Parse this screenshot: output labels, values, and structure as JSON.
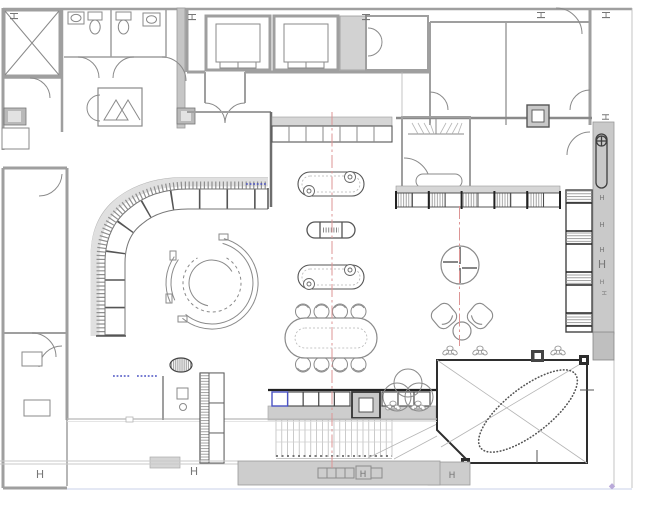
{
  "drawing": {
    "kind": "architectural-floor-plan",
    "width_px": 650,
    "height_px": 508
  },
  "colors": {
    "wall": "#9f9f9f",
    "dark": "#3f3f3f",
    "ln": "#8a8a8a",
    "thin": "#b5b5b5",
    "fillg": "#cdcdcd",
    "filll": "#e3e3e3",
    "red": "#dd9595",
    "blue": "#4a52c4",
    "lav": "#b9a9d9",
    "marker": "#777777"
  },
  "grid_markers": {
    "label": "H",
    "items": [
      {
        "x": 10,
        "y": 16,
        "r": 90,
        "s": 11
      },
      {
        "x": 188,
        "y": 17,
        "r": 90,
        "s": 11
      },
      {
        "x": 362,
        "y": 17,
        "r": 90,
        "s": 11
      },
      {
        "x": 537,
        "y": 15,
        "r": 90,
        "s": 11
      },
      {
        "x": 602,
        "y": 15,
        "r": 90,
        "s": 11
      },
      {
        "x": 602,
        "y": 117,
        "r": 90,
        "s": 10
      },
      {
        "x": 602,
        "y": 200,
        "r": 0,
        "s": 7
      },
      {
        "x": 602,
        "y": 227,
        "r": 0,
        "s": 7
      },
      {
        "x": 602,
        "y": 252,
        "r": 0,
        "s": 7
      },
      {
        "x": 602,
        "y": 268,
        "r": 0,
        "s": 11
      },
      {
        "x": 602,
        "y": 284,
        "r": 0,
        "s": 6
      },
      {
        "x": 602,
        "y": 293,
        "r": 90,
        "s": 6
      },
      {
        "x": 40,
        "y": 478,
        "r": 0,
        "s": 11
      },
      {
        "x": 194,
        "y": 475,
        "r": 0,
        "s": 11
      },
      {
        "x": 363,
        "y": 477,
        "r": 0,
        "s": 9
      },
      {
        "x": 452,
        "y": 478,
        "r": 0,
        "s": 9
      }
    ]
  },
  "centerlines": {
    "color": "#dd9595",
    "vertical": [
      {
        "x": 332,
        "y1": 112,
        "y2": 468
      },
      {
        "x": 459.5,
        "y1": 206,
        "y2": 346
      }
    ]
  },
  "furniture_counts": {
    "elevator_shafts": 2,
    "display_capsule_tables": 3,
    "conference_chairs": 8,
    "lounge_armchairs": 2,
    "plant_symbols": 5
  }
}
